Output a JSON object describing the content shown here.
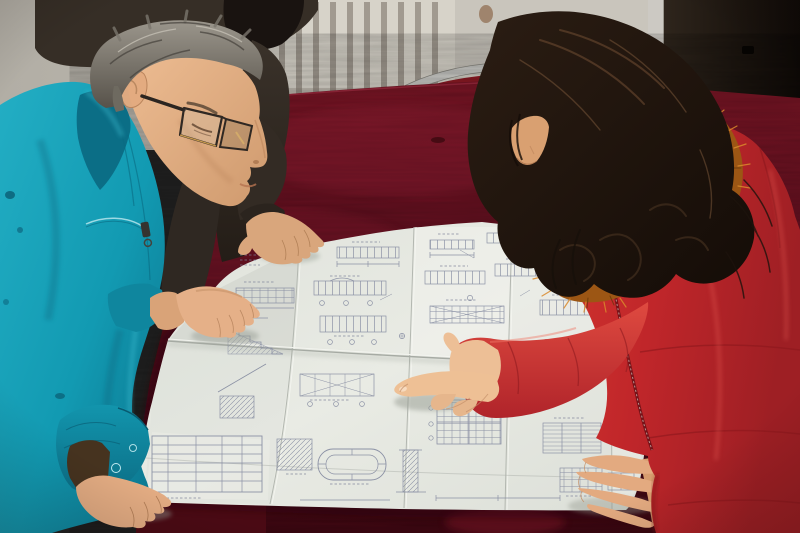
{
  "scene": {
    "description": "Three people lean over a large folded construction blueprint spread on a table covered with dark red crushed velvet: a gray-haired man in a teal work jacket and glasses on the left, a partially visible person in a dark brown jacket behind him resting a hand on the drawing, and a woman in a red down coat with an orange fur-trimmed hood pointing at the drawing on the right. Behind them are a pale ribbed radiator, a light wall, a dark door panel and a chrome-framed chair with a red back.",
    "people": [
      {
        "id": "man-teal",
        "appearance": "gray-haired man, glasses, teal work jacket",
        "pose": "leaning over drawing, both hands on paper"
      },
      {
        "id": "person-dark",
        "appearance": "person in dark brown jacket, black hair",
        "pose": "standing behind, right hand resting on drawing"
      },
      {
        "id": "woman-red",
        "appearance": "woman with long dark wavy hair, red fur-trimmed down coat",
        "pose": "pointing at drawing with right index finger, left hand resting on paper"
      }
    ],
    "objects": [
      {
        "id": "blueprint",
        "type": "large folded technical drawing with beam elevations, section details, schedule tables and an oval tank detail"
      },
      {
        "id": "table",
        "type": "table draped in dark red velvet"
      },
      {
        "id": "radiator",
        "type": "pale vertical-fin radiator"
      },
      {
        "id": "chair",
        "type": "chrome tube chair with red back"
      },
      {
        "id": "door",
        "type": "dark brown door panel"
      }
    ]
  },
  "palette": {
    "wall": "#b7b3aa",
    "wall_right": "#c9c5bc",
    "radiator": "#d7d3c9",
    "radiator_slot": "#6b6257",
    "jamb": "#ccc9c3",
    "door_dark": "#231c15",
    "door_slot": "#080503",
    "chrome": "#c9c9c5",
    "chair_red": "#8c1a24",
    "velvet_light": "#7d1626",
    "velvet_dark": "#420813",
    "velvet_corner": "#4a0a14",
    "paper": "#e4e6e0",
    "ink": "#848aa0",
    "teal": "#149cb4",
    "teal_dark": "#0b6e86",
    "skin_man": "#e5b088",
    "skin_woman": "#edbf96",
    "hair_gray": "#8f8a80",
    "hair_dark": "#191310",
    "hair_woman": "#1d130c",
    "coat_red": "#c4262b",
    "coat_deep": "#8f1a1f",
    "fur_orange": "#9c5614",
    "fur_bright": "#d98a2c",
    "dark_jacket": "#362e26",
    "glasses_frame": "#2f2823",
    "glasses_gold": "#c89a4e"
  }
}
